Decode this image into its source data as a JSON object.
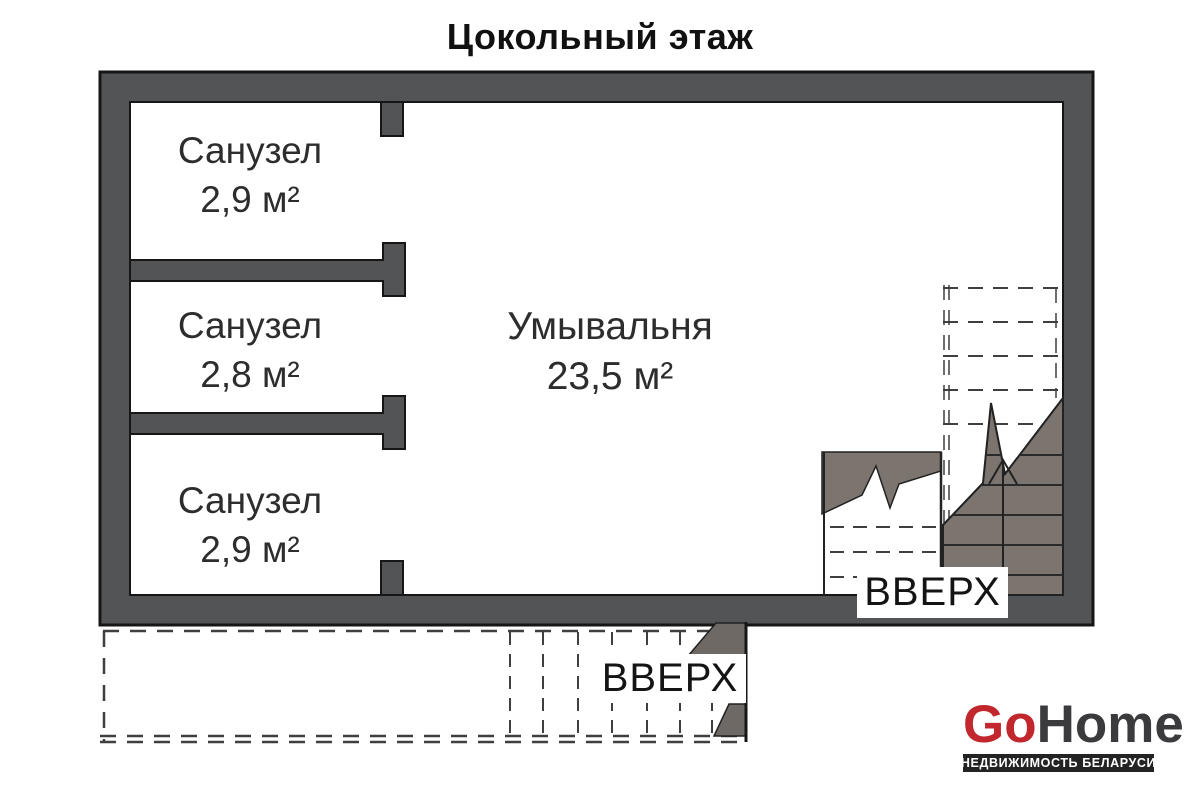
{
  "page": {
    "title": "Цокольный этаж"
  },
  "plan": {
    "rooms": [
      {
        "name": "Санузел",
        "area": "2,9 м²"
      },
      {
        "name": "Санузел",
        "area": "2,8 м²"
      },
      {
        "name": "Санузел",
        "area": "2,9 м²"
      },
      {
        "name": "Умывальня",
        "area": "23,5 м²"
      }
    ],
    "stair_labels": {
      "interior": "ВВЕРХ",
      "exterior": "ВВЕРХ"
    },
    "colors": {
      "wall": "#535456",
      "stair_fill": "#7b746f",
      "stair_fill_dark": "#6f6965",
      "outline": "#161616",
      "dashed_line": "#3f3f3f"
    }
  },
  "logo": {
    "go": "Go",
    "home": "Home",
    "tagline": "НЕДВИЖИМОСТЬ БЕЛАРУСИ",
    "go_color": "#c1272d",
    "home_color": "#3b3b3d",
    "tagline_bg": "#232323",
    "tagline_color": "#ffffff"
  }
}
